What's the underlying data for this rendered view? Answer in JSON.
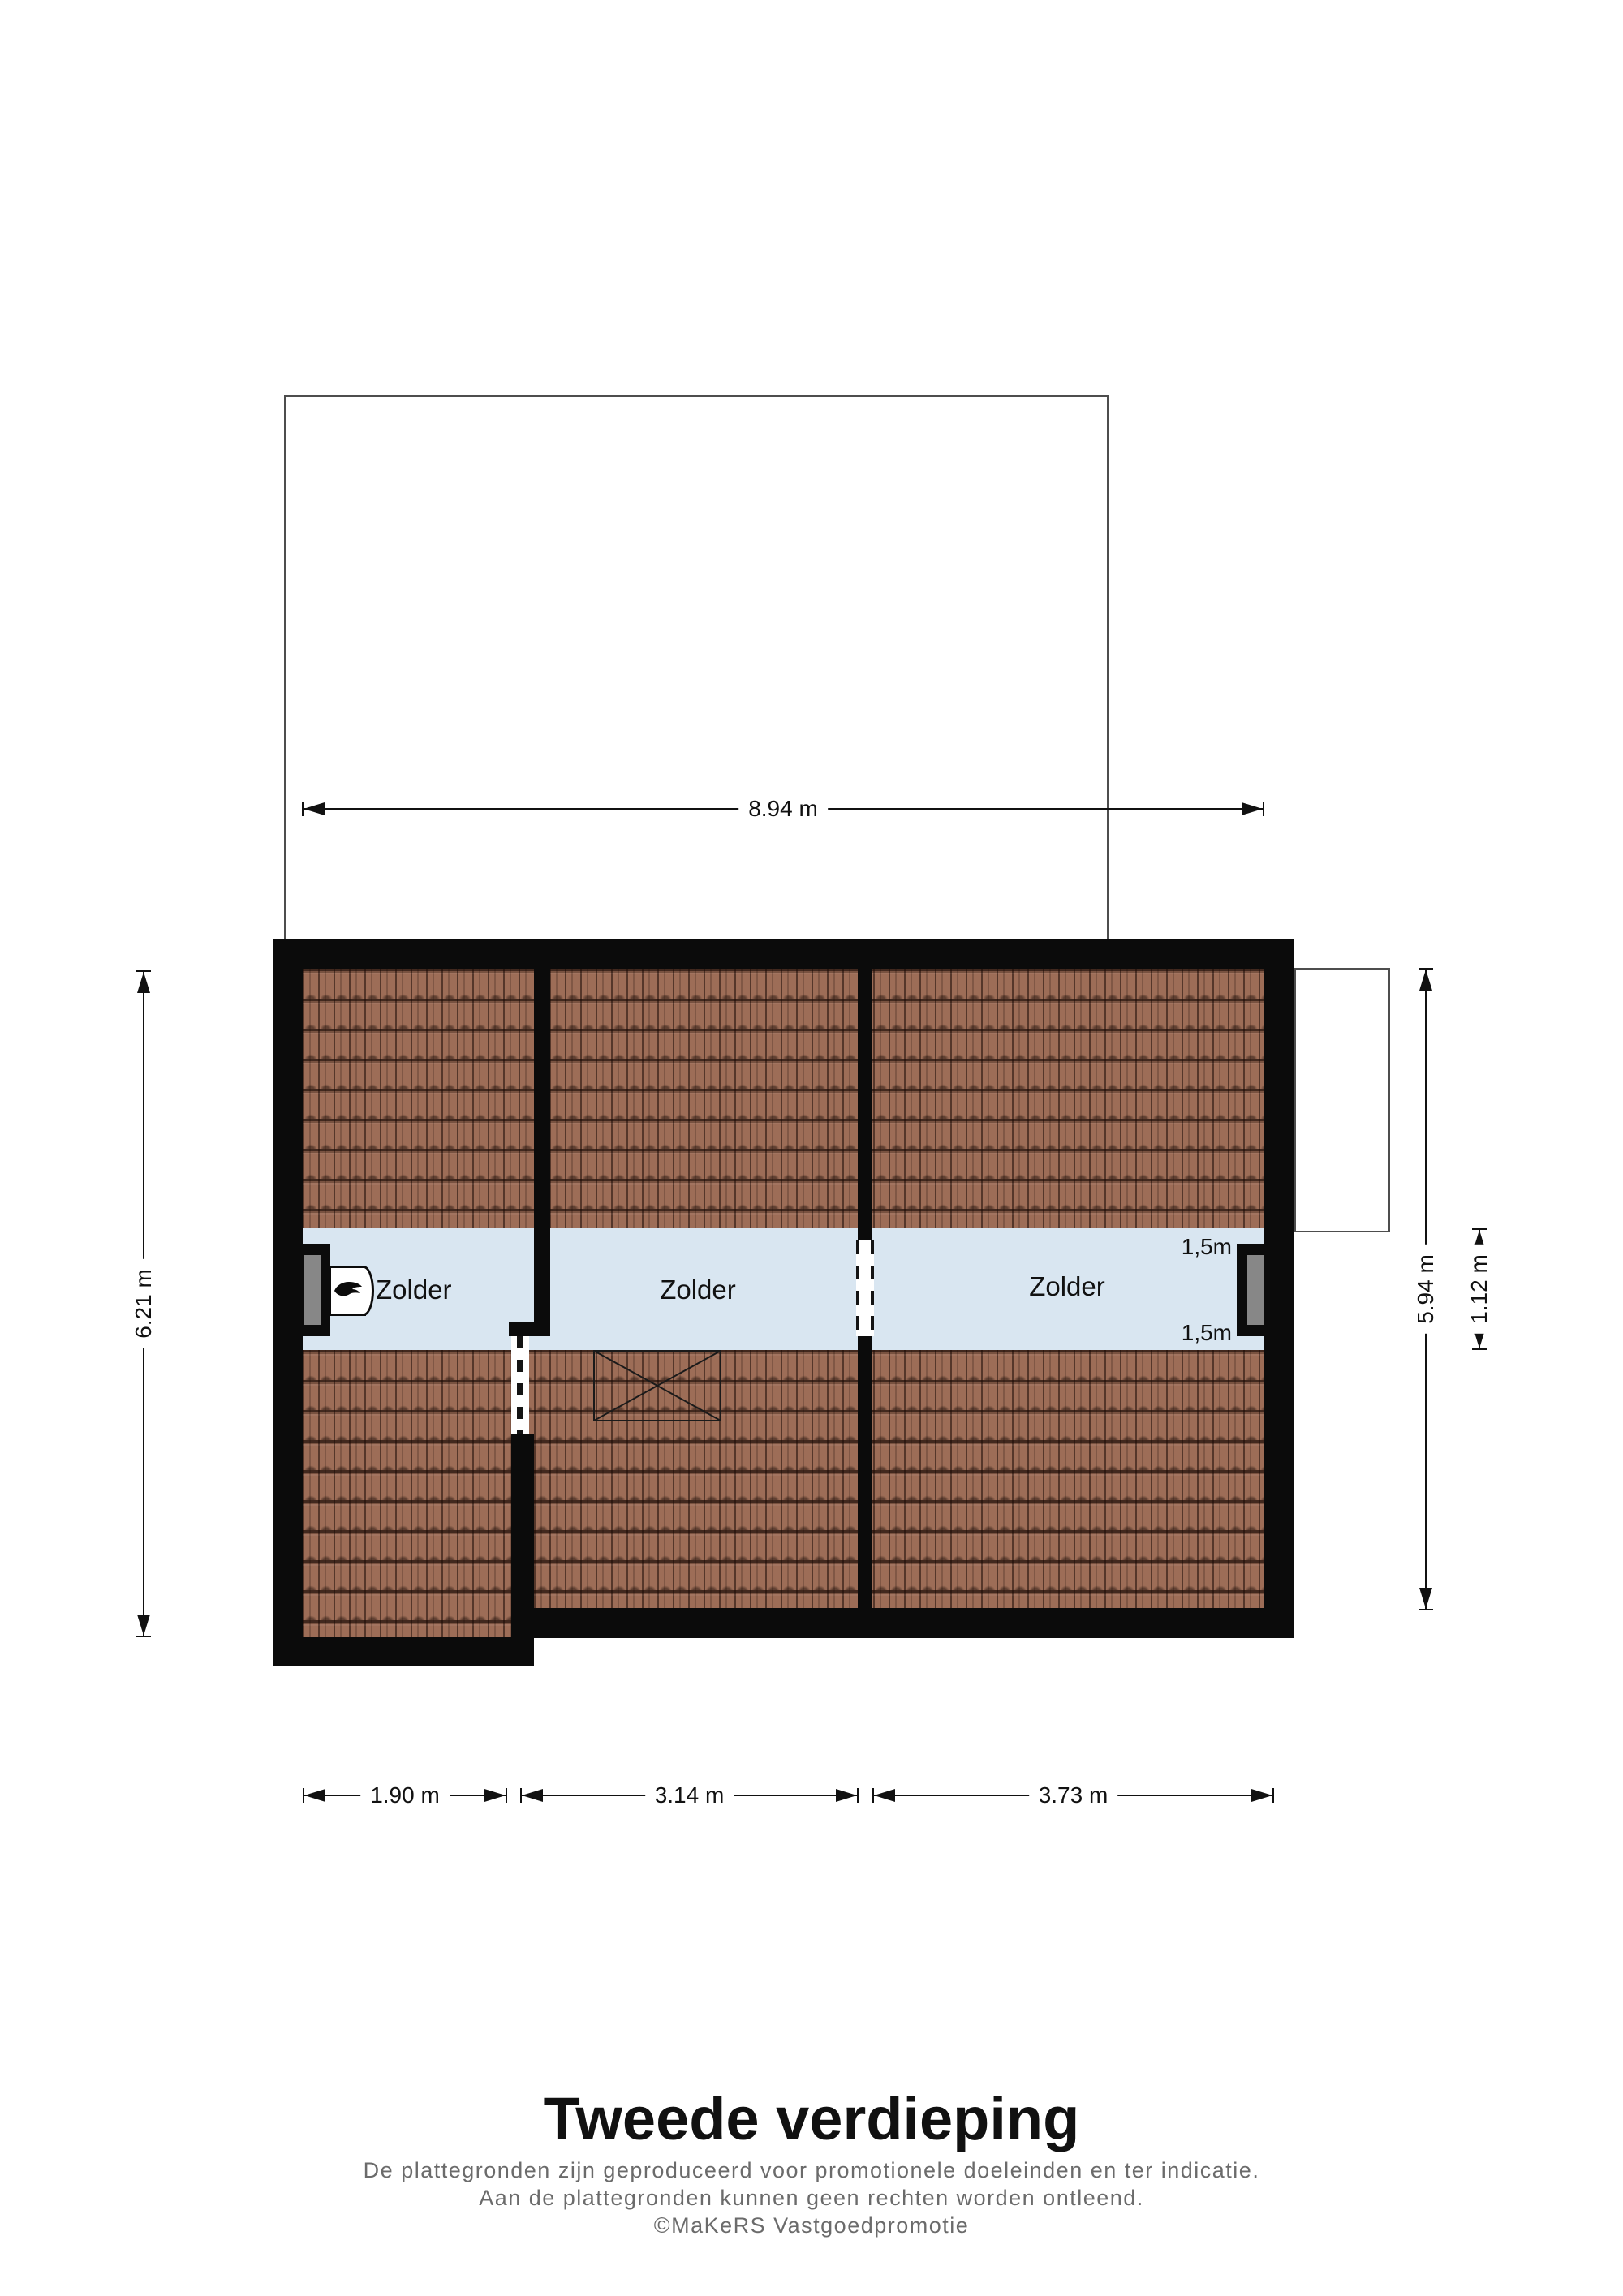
{
  "floorplan": {
    "title": "Tweede verdieping",
    "disclaimer": [
      "De plattegronden zijn geproduceerd voor promotionele doeleinden en ter indicatie.",
      "Aan de plattegronden kunnen geen rechten worden ontleend.",
      "©MaKeRS Vastgoedpromotie"
    ],
    "rooms": [
      {
        "label": "Zolder"
      },
      {
        "label": "Zolder"
      },
      {
        "label": "Zolder"
      }
    ],
    "headroom_top": "1,5m",
    "headroom_bottom": "1,5m",
    "dimensions": {
      "overall_width": "8.94 m",
      "left_height": "6.21 m",
      "right_height": "5.94 m",
      "floor_strip_height": "1.12 m",
      "bottom_left": "1.90 m",
      "bottom_middle": "3.14 m",
      "bottom_right": "3.73 m"
    },
    "icons": {
      "boiler": "boiler-flame-icon",
      "stairwell": "stairwell-cross-icon"
    },
    "colors": {
      "wall": "#0b0b0b",
      "floor": "#d9e6f1",
      "roof_tile": "#9d6d57",
      "window_glass": "#878787",
      "outline": "#4d4d4d",
      "disclaimer_text": "#6b6b6b"
    }
  }
}
